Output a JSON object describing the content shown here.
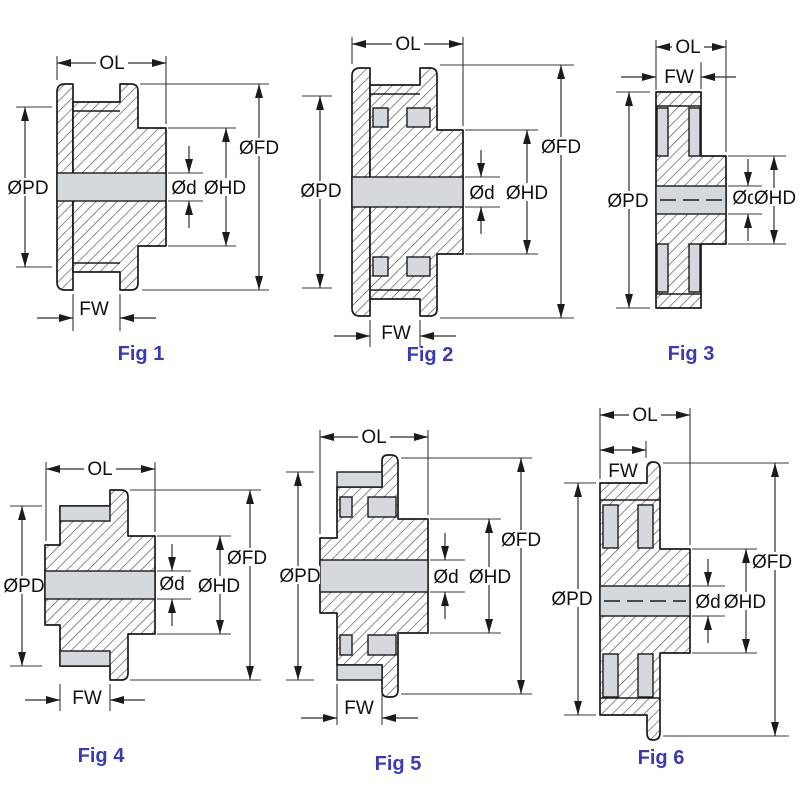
{
  "sheet_title": "Timing pulley cross-section dimension figures",
  "labels": {
    "overall_length": "OL",
    "face_width": "FW",
    "pitch_diameter": "ØPD",
    "flange_diameter": "ØFD",
    "hub_diameter": "ØHD",
    "bore_diameter": "Ød"
  },
  "figures": [
    {
      "caption": "Fig 1"
    },
    {
      "caption": "Fig 2"
    },
    {
      "caption": "Fig 3"
    },
    {
      "caption": "Fig 4"
    },
    {
      "caption": "Fig 5"
    },
    {
      "caption": "Fig 6"
    }
  ],
  "colors": {
    "caption": "#3a3ab8",
    "line": "#1b1b1b",
    "fill_light": "#d5d8dd",
    "background": "#ffffff"
  }
}
